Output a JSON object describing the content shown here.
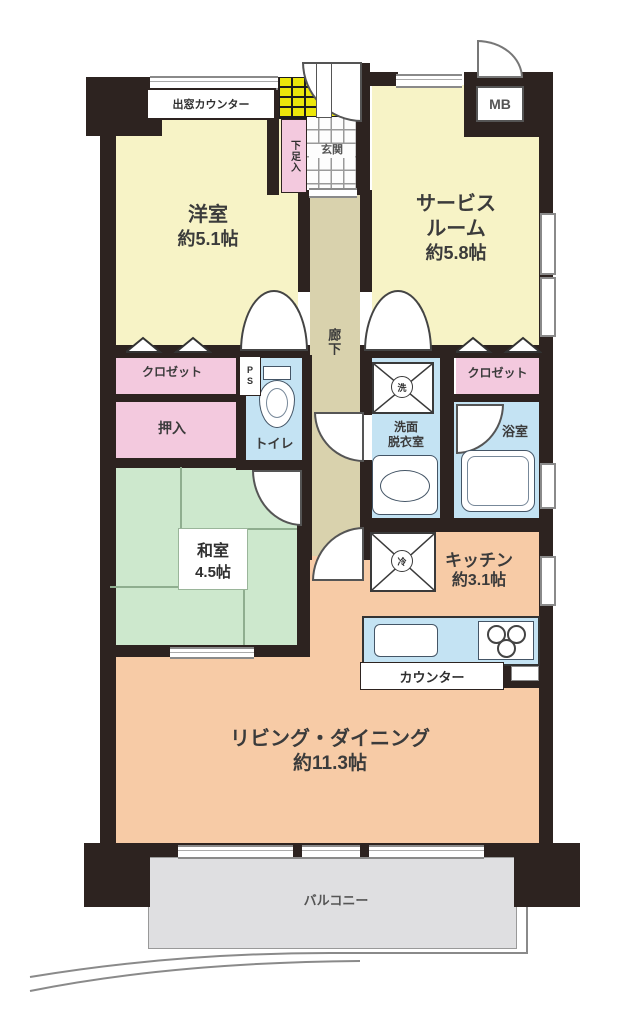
{
  "plan": {
    "type": "japanese-apartment-floorplan",
    "colors": {
      "wall": "#2d2320",
      "room_yellow": "#f7f3c6",
      "room_green": "#cde8cd",
      "room_pink": "#f3c9de",
      "room_blue": "#c4e3f3",
      "room_salmon": "#f7cba6",
      "corridor_beige": "#d9d2ad",
      "porch_yellow": "#ece70a",
      "balcony_gray": "#dfdfe1"
    },
    "rooms": {
      "bay_window_counter": {
        "label": "出窓カウンター"
      },
      "meter_box": {
        "label": "MB"
      },
      "shoe_cabinet": {
        "label": "下足入"
      },
      "entrance": {
        "label": "玄関"
      },
      "western_room": {
        "name": "洋室",
        "size": "約5.1帖"
      },
      "service_room": {
        "name_line1": "サービス",
        "name_line2": "ルーム",
        "size": "約5.8帖"
      },
      "corridor": {
        "label": "廊下"
      },
      "closet_left": {
        "label": "クロゼット"
      },
      "pipe_space": {
        "label": "PS"
      },
      "toilet": {
        "label": "トイレ"
      },
      "washer": {
        "label": "洗"
      },
      "washroom": {
        "name_line1": "洗面",
        "name_line2": "脱衣室"
      },
      "closet_right": {
        "label": "クロゼット"
      },
      "bathroom": {
        "label": "浴室"
      },
      "oshiire": {
        "label": "押入"
      },
      "japanese_room": {
        "name": "和室",
        "size": "4.5帖"
      },
      "refrigerator": {
        "label": "冷"
      },
      "kitchen": {
        "name": "キッチン",
        "size": "約3.1帖"
      },
      "counter": {
        "label": "カウンター"
      },
      "living_dining": {
        "name": "リビング・ダイニング",
        "size": "約11.3帖"
      },
      "balcony": {
        "label": "バルコニー"
      }
    }
  }
}
